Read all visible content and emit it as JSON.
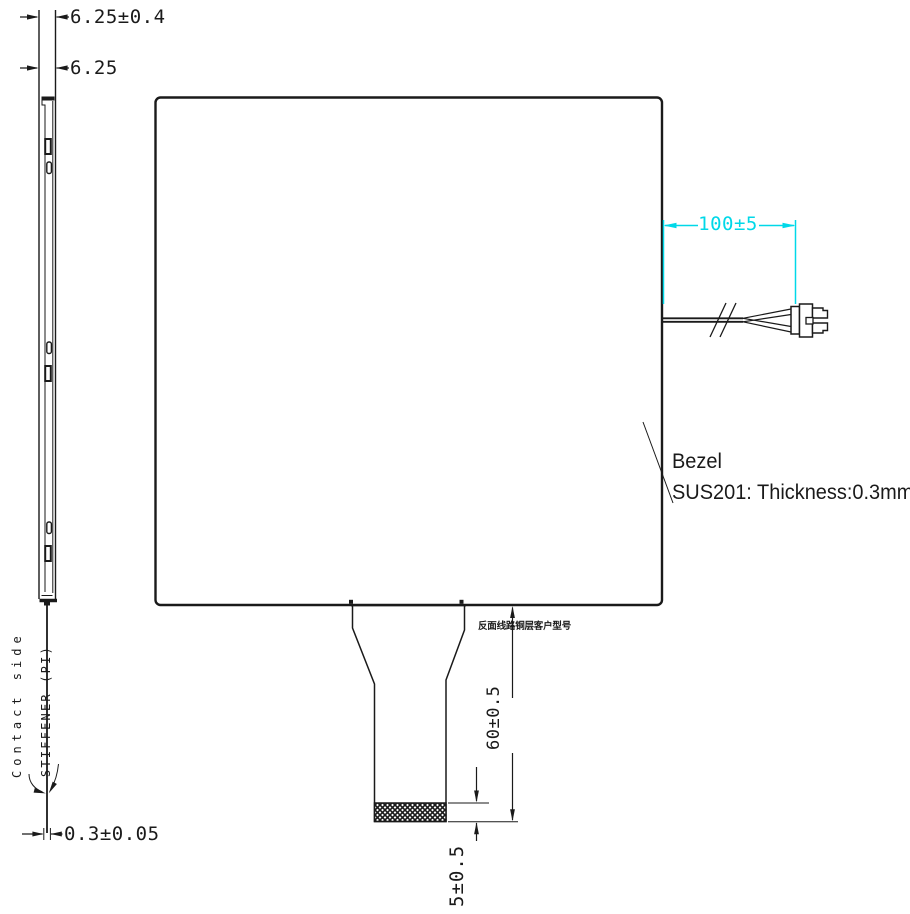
{
  "colors": {
    "line": "#1a1a1a",
    "accent_cyan": "#00d8e8",
    "background": "#ffffff"
  },
  "side_view": {
    "dims": {
      "overall_thickness": "6.25±0.4",
      "stack_thickness": "6.25",
      "fpc_thickness": "0.3±0.05"
    },
    "labels": {
      "contact_side": "Contact side",
      "stiffener": "STIFFENER (PI)"
    }
  },
  "front_view": {
    "bezel": {
      "line1": "Bezel",
      "line2": "SUS201: Thickness:0.3mm"
    },
    "cable": {
      "length_dim": "100±5"
    },
    "tail": {
      "note_cn": "反面线路铜层客户型号",
      "length_dim": "60±0.5",
      "stiffener_dim": "5±0.5"
    }
  }
}
